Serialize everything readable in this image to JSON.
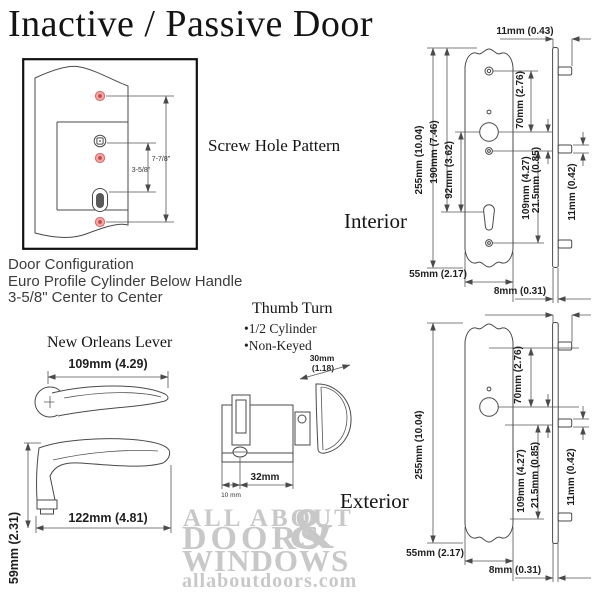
{
  "title": "Inactive / Passive Door",
  "screw_pattern": {
    "label": "Screw Hole Pattern",
    "dim_outer": "7-7/8\"",
    "dim_inner": "3-5/8\""
  },
  "door_config": {
    "line1": "Door Configuration",
    "line2": "Euro Profile Cylinder Below Handle",
    "line3": "3-5/8\" Center to Center"
  },
  "lever": {
    "title": "New Orleans Lever",
    "dim_width": "109mm (4.29)",
    "dim_length": "122mm (4.81)",
    "dim_height": "59mm (2.31)"
  },
  "thumb_turn": {
    "title": "Thumb Turn",
    "bullet1": "•1/2 Cylinder",
    "bullet2": "•Non-Keyed",
    "dim_wing1": "30mm",
    "dim_wing2": "(1.18)",
    "dim_body": "32mm",
    "dim_offset": "10 mm"
  },
  "interior": {
    "label": "Interior",
    "dim_top_width": "11mm (0.43)",
    "dim_total_height": "255mm (10.04)",
    "dim_screw_span": "190mm (7.46)",
    "dim_handle_to_cyl": "92mm (3.62)",
    "dim_top_to_handle": "70mm (2.76)",
    "dim_handle_to_bottom": "109mm (4.27)",
    "dim_handle_offset": "21.5mm (0.85)",
    "dim_tab": "11mm (0.42)",
    "dim_plate_width": "55mm (2.17)",
    "dim_side_width": "8mm (0.31)"
  },
  "exterior": {
    "label": "Exterior",
    "dim_total_height": "255mm (10.04)",
    "dim_top_to_handle": "70mm (2.76)",
    "dim_handle_to_bottom": "109mm (4.27)",
    "dim_handle_offset": "21.5mm (0.85)",
    "dim_tab": "11mm (0.42)",
    "dim_plate_width": "55mm (2.17)",
    "dim_side_width": "8mm (0.31)"
  },
  "watermark": {
    "line1": "ALL ABOUT",
    "line2": "DOORS",
    "amp": "&",
    "line3": "WINDOWS",
    "line4": "allaboutdoors.com"
  }
}
